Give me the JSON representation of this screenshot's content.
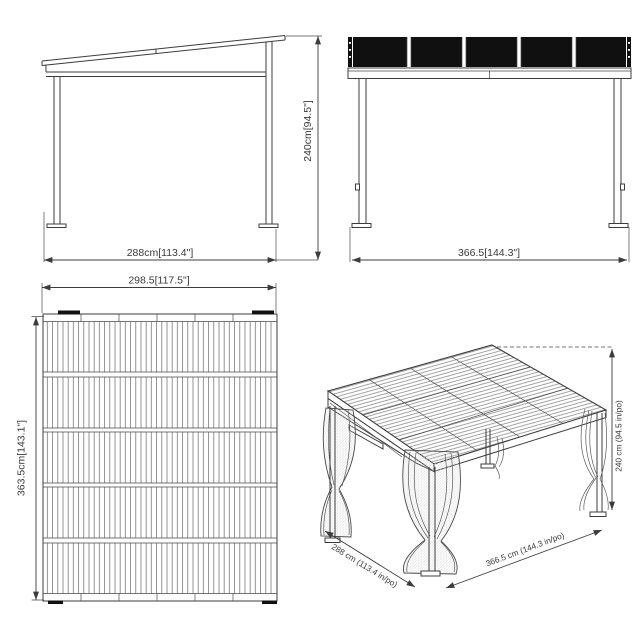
{
  "diagram": {
    "title": "gazebo-dimension-drawing",
    "colors": {
      "background": "#ffffff",
      "line": "#3c3c3c",
      "roof_panel_fill": "#101010"
    },
    "views": {
      "side": {
        "width_label": "288cm[113.4\"]",
        "height_label": "240cm[94.5\"]"
      },
      "front": {
        "width_label": "366.5[144.3\"]"
      },
      "top": {
        "width_label": "298.5[117.5\"]",
        "height_label": "363.5cm[143.1\"]"
      },
      "perspective": {
        "depth_label": "288 cm (113.4 in/po)",
        "width_label": "366.5 cm (144.3 in/po)",
        "height_label": "240 cm (94.5 in/po)"
      }
    }
  }
}
